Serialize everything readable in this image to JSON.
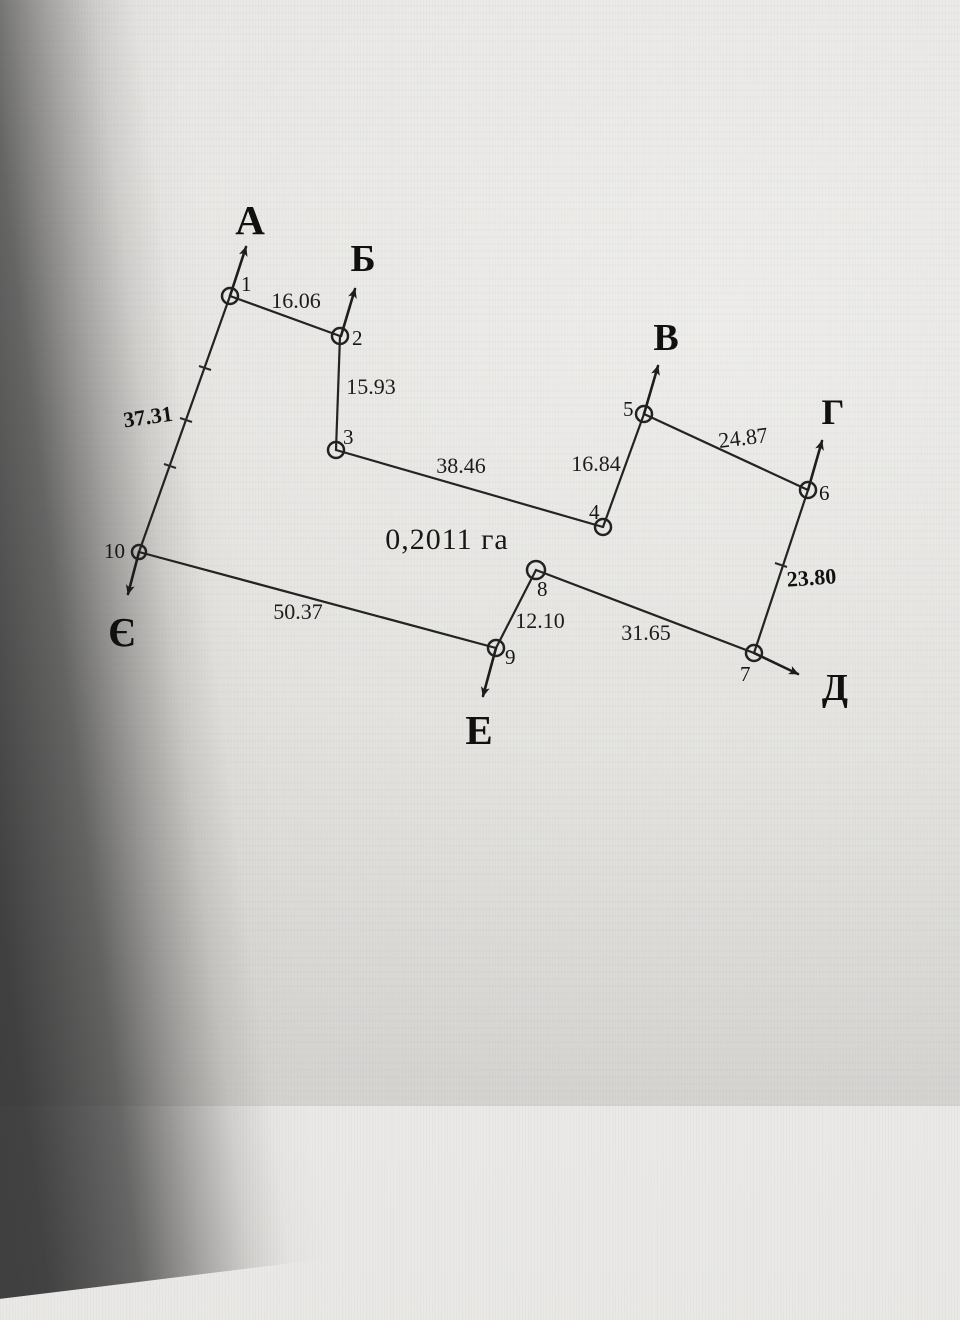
{
  "plan": {
    "area_label": "0,2011 га",
    "points": [
      {
        "number": "1"
      },
      {
        "number": "2"
      },
      {
        "number": "3"
      },
      {
        "number": "4"
      },
      {
        "number": "5"
      },
      {
        "number": "6"
      },
      {
        "number": "7"
      },
      {
        "number": "8"
      },
      {
        "number": "9"
      },
      {
        "number": "10"
      }
    ],
    "edges": [
      {
        "from": "1",
        "to": "2",
        "length": "16.06"
      },
      {
        "from": "2",
        "to": "3",
        "length": "15.93"
      },
      {
        "from": "3",
        "to": "4",
        "length": "38.46"
      },
      {
        "from": "4",
        "to": "5",
        "length": "16.84"
      },
      {
        "from": "5",
        "to": "6",
        "length": "24.87"
      },
      {
        "from": "6",
        "to": "7",
        "length": "23.80"
      },
      {
        "from": "7",
        "to": "8",
        "length": "31.65"
      },
      {
        "from": "8",
        "to": "9",
        "length": "12.10"
      },
      {
        "from": "9",
        "to": "10",
        "length": "50.37"
      },
      {
        "from": "10",
        "to": "1",
        "length": "37.31"
      }
    ],
    "adjacent_parcels": [
      {
        "letter": "А"
      },
      {
        "letter": "Б"
      },
      {
        "letter": "В"
      },
      {
        "letter": "Г"
      },
      {
        "letter": "Д"
      },
      {
        "letter": "Е"
      },
      {
        "letter": "Є"
      }
    ]
  }
}
